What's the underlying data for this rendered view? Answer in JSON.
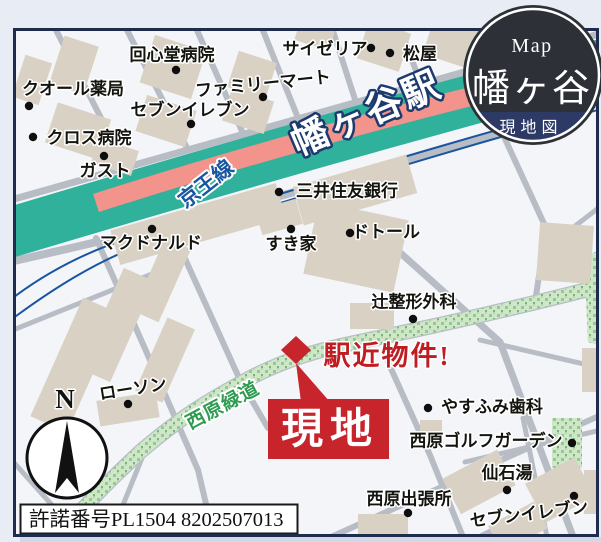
{
  "header_badge": {
    "map_label": "Map",
    "area_name": "幡ヶ谷",
    "map_type_label": "現地図"
  },
  "features": {
    "station_name": "幡ヶ谷駅",
    "rail_line_name": "京王線",
    "greenway_name": "西原緑道"
  },
  "site": {
    "label": "現地",
    "callout": "駅近物件!"
  },
  "compass": {
    "north_label": "N"
  },
  "license": {
    "text": "許諾番号PL1504 8202507013"
  },
  "colors": {
    "railway_teal": "#2fb19c",
    "station_salmon": "#f2938c",
    "road_gray": "#b8bcc5",
    "building_beige": "#d9d2c4",
    "greenway_green": "#cfe6c8",
    "accent_red": "#c8242b",
    "badge_dark": "#2d3036",
    "badge_navy": "#2e3a66",
    "frame_navy": "#1f2c4e",
    "line_blue": "#1a55a0"
  },
  "pois": [
    {
      "name": "回心堂病院",
      "x": 172,
      "y": 55,
      "dot_x": 176,
      "dot_y": 70
    },
    {
      "name": "クオール薬局",
      "x": 73,
      "y": 89,
      "dot_x": 29,
      "dot_y": 106
    },
    {
      "name": "サイゼリア",
      "x": 325,
      "y": 49,
      "dot_x": 371,
      "dot_y": 48
    },
    {
      "name": "松屋",
      "x": 420,
      "y": 54,
      "dot_x": 390,
      "dot_y": 53
    },
    {
      "name": "ファミリーマート",
      "x": 263,
      "y": 84,
      "rot": -6,
      "dot_x": 263,
      "dot_y": 97
    },
    {
      "name": "セブンイレブン",
      "x": 190,
      "y": 110,
      "dot_x": 191,
      "dot_y": 124
    },
    {
      "name": "クロス病院",
      "x": 89,
      "y": 138,
      "dot_x": 33,
      "dot_y": 137
    },
    {
      "name": "ガスト",
      "x": 105,
      "y": 171,
      "dot_x": 104,
      "dot_y": 156
    },
    {
      "name": "三井住友銀行",
      "x": 347,
      "y": 191,
      "dot_x": 279,
      "dot_y": 192
    },
    {
      "name": "マクドナルド",
      "x": 151,
      "y": 243,
      "dot_x": 152,
      "dot_y": 229
    },
    {
      "name": "すき家",
      "x": 291,
      "y": 244,
      "dot_x": 291,
      "dot_y": 229
    },
    {
      "name": "ドトール",
      "x": 386,
      "y": 232,
      "dot_x": 350,
      "dot_y": 233
    },
    {
      "name": "辻整形外科",
      "x": 414,
      "y": 302,
      "dot_x": 413,
      "dot_y": 319
    },
    {
      "name": "ローソン",
      "x": 133,
      "y": 389,
      "rot": -9,
      "dot_x": 128,
      "dot_y": 404
    },
    {
      "name": "やすふみ歯科",
      "x": 492,
      "y": 407,
      "dot_x": 428,
      "dot_y": 408
    },
    {
      "name": "西原ゴルフガーデン",
      "x": 486,
      "y": 441,
      "dot_x": 572,
      "dot_y": 443
    },
    {
      "name": "仙石湯",
      "x": 507,
      "y": 473,
      "dot_x": 507,
      "dot_y": 490
    },
    {
      "name": "西原出張所",
      "x": 409,
      "y": 499,
      "dot_x": 408,
      "dot_y": 513
    },
    {
      "name": "セブンイレブン",
      "x": 529,
      "y": 514,
      "rot": -7,
      "dot_x": 574,
      "dot_y": 496
    }
  ]
}
